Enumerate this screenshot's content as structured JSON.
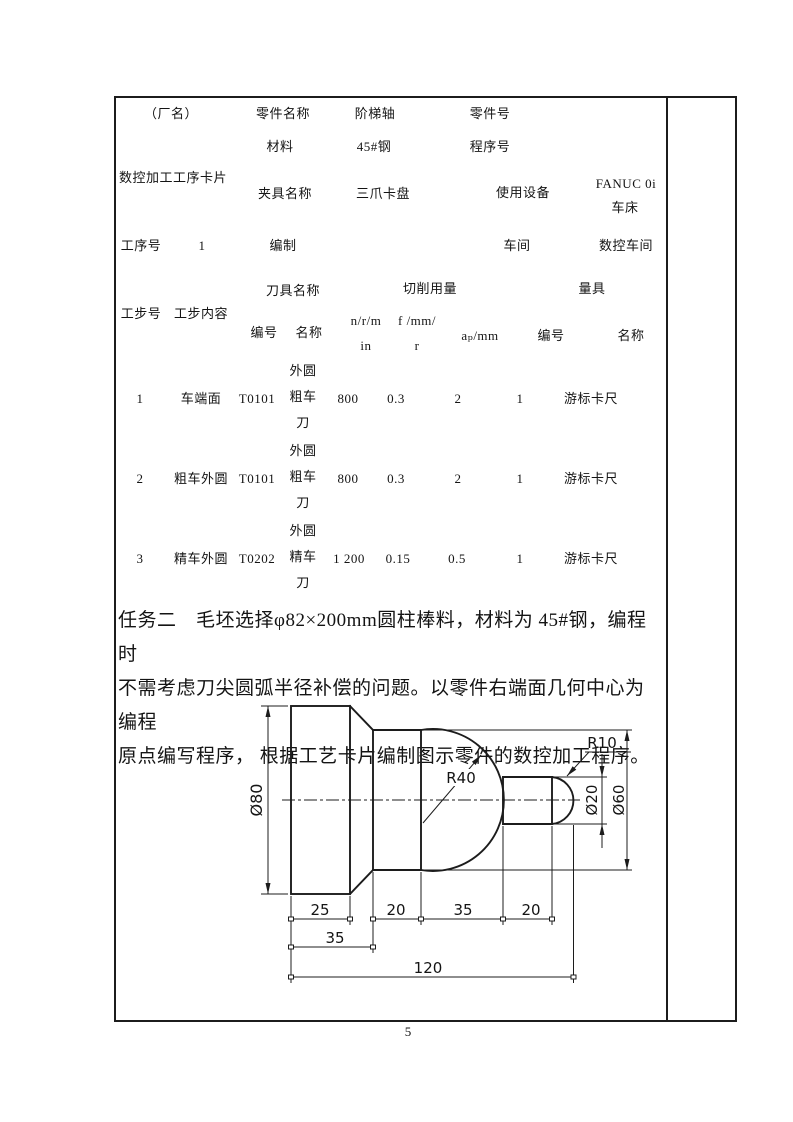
{
  "process_card": {
    "factory_label": "（厂名）",
    "card_title": "数控加工工序卡片",
    "part_name_label": "零件名称",
    "part_name": "阶梯轴",
    "part_no_label": "零件号",
    "material_label": "材料",
    "material": "45#钢",
    "program_no_label": "程序号",
    "fixture_label": "夹具名称",
    "fixture": "三爪卡盘",
    "equipment_label": "使用设备",
    "equipment_line1": "FANUC 0i",
    "equipment_line2": "车床",
    "process_no_label": "工序号",
    "process_no": "1",
    "compiled_label": "编制",
    "workshop_label": "车间",
    "workshop": "数控车间"
  },
  "steps_table": {
    "step_no_label": "工步号",
    "step_content_label": "工步内容",
    "tool_group_label": "刀具名称",
    "cutting_group_label": "切削用量",
    "gauge_group_label": "量具",
    "tool_no_label": "编号",
    "tool_name_label": "名称",
    "spindle_label": "n/r/m\nin",
    "feed_label": "f /mm/\nr",
    "ap_label": "aₚ/mm",
    "gauge_no_label": "编号",
    "gauge_name_label": "名称",
    "rows": [
      {
        "no": "1",
        "content": "车端面",
        "tool_no": "T0101",
        "tool_name": "外圆\n粗车\n刀",
        "n": "800",
        "f": "0.3",
        "ap": "2",
        "gauge_no": "1",
        "gauge_name": "游标卡尺"
      },
      {
        "no": "2",
        "content": "粗车外圆",
        "tool_no": "T0101",
        "tool_name": "外圆\n粗车\n刀",
        "n": "800",
        "f": "0.3",
        "ap": "2",
        "gauge_no": "1",
        "gauge_name": "游标卡尺"
      },
      {
        "no": "3",
        "content": "精车外圆",
        "tool_no": "T0202",
        "tool_name": "外圆\n精车\n刀",
        "n": "1 200",
        "f": "0.15",
        "ap": "0.5",
        "gauge_no": "1",
        "gauge_name": "游标卡尺"
      }
    ]
  },
  "task": {
    "text": "任务二　毛坯选择φ82×200mm圆柱棒料，材料为 45#钢，编程时\n不需考虑刀尖圆弧半径补偿的问题。以零件右端面几何中心为编程\n原点编写程序， 根据工艺卡片编制图示零件的数控加工程序。"
  },
  "drawing": {
    "dia_80": "Ø80",
    "r40": "R40",
    "r10": "R10",
    "dia_20": "Ø20",
    "dia_60": "Ø60",
    "len_25": "25",
    "len_20a": "20",
    "len_35a": "35",
    "len_20b": "20",
    "len_35b": "35",
    "len_120": "120"
  },
  "page": {
    "number": "5"
  }
}
